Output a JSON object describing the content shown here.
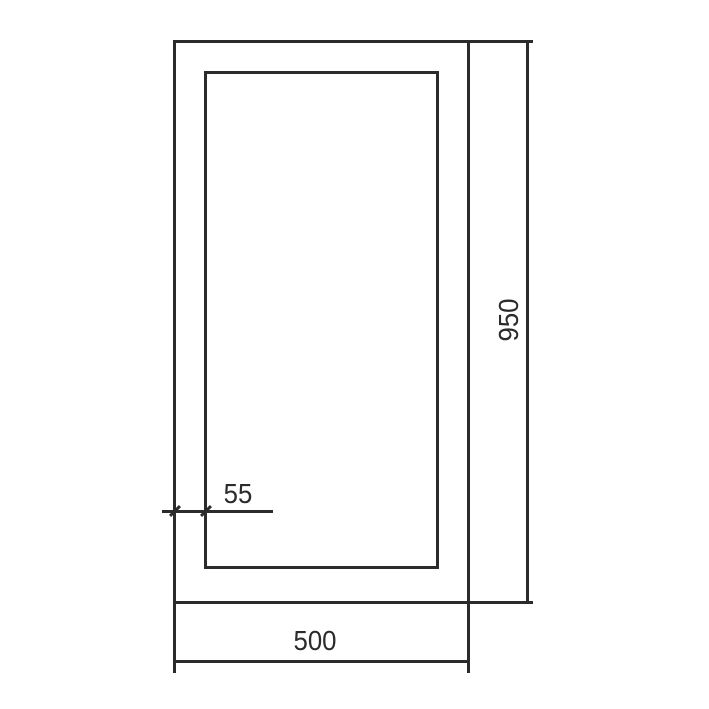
{
  "diagram": {
    "type": "technical-drawing",
    "description": "Front elevation of a rectangular frame with an inner panel offset from the outer edge",
    "line_color": "#2b2b2b",
    "background_color": "#ffffff",
    "shapes": [
      {
        "name": "outer-rectangle",
        "kind": "rectangle"
      },
      {
        "name": "inner-rectangle",
        "kind": "rectangle",
        "offset_from_outer": "55"
      }
    ],
    "dimensions": [
      {
        "name": "overall-height",
        "label": "950",
        "orientation": "vertical",
        "side": "right",
        "terminator": "none"
      },
      {
        "name": "overall-width",
        "label": "500",
        "orientation": "horizontal",
        "side": "bottom",
        "terminator": "none"
      },
      {
        "name": "edge-offset",
        "label": "55",
        "orientation": "horizontal",
        "side": "lower-left",
        "terminator": "oblique-ticks"
      }
    ]
  }
}
